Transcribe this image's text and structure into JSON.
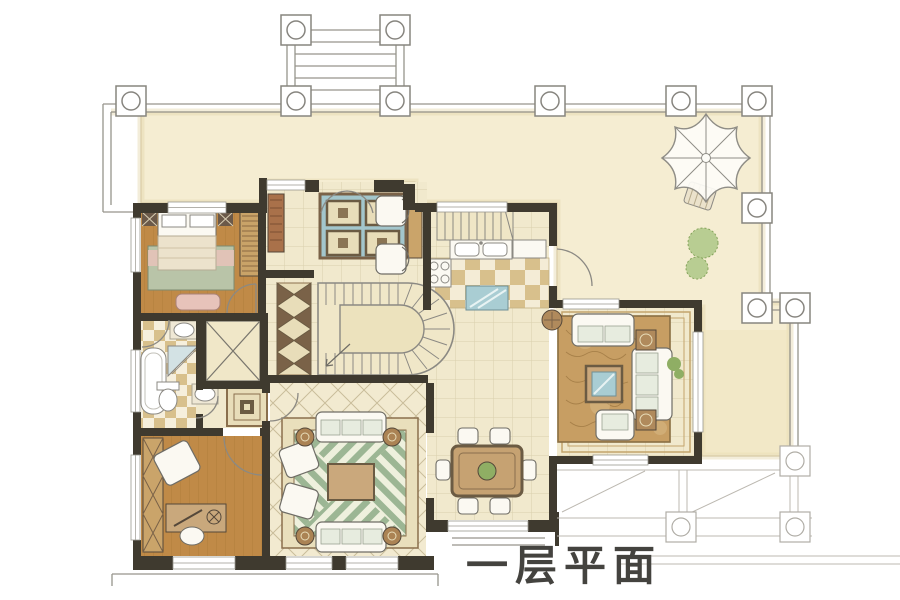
{
  "legend": {
    "caption": "一层平面"
  },
  "palette": {
    "paper": "#ffffff",
    "terrace": "#f5edd2",
    "terrace_edge": "#d9cca4",
    "tile": "#f1e9cd",
    "tile_grid": "#d9cfad",
    "wood": "#c08a47",
    "wood_line": "#a1722f",
    "wall": "#3f3a2f",
    "thin_line": "#96948c",
    "pencil": "#bcb8b0",
    "checker_dark": "#d8c08c",
    "checker_light": "#f4ecd6",
    "rug_sage": "#b9c4a8",
    "rug_pink": "#e7c3ba",
    "rug_brown": "#c79e63",
    "chevron_green": "#9cb694",
    "glass_blue": "#a9cdd3",
    "medallion_blue": "#a3c6cc",
    "furniture_tan": "#caa46a",
    "furniture_white": "#fbf9f2",
    "cushion": "#e7ecdf",
    "plant_green": "#9ebf77",
    "ink": "#44433f"
  },
  "rooms": [
    "terrace",
    "entry-steps",
    "foyer",
    "staircase",
    "elevator",
    "master-bedroom",
    "bathroom",
    "hallway",
    "kitchen",
    "living-room",
    "dining-room",
    "family-room",
    "study"
  ],
  "symbols": [
    "column-icon",
    "parasol-icon",
    "plant-icon",
    "door-arc",
    "window"
  ]
}
